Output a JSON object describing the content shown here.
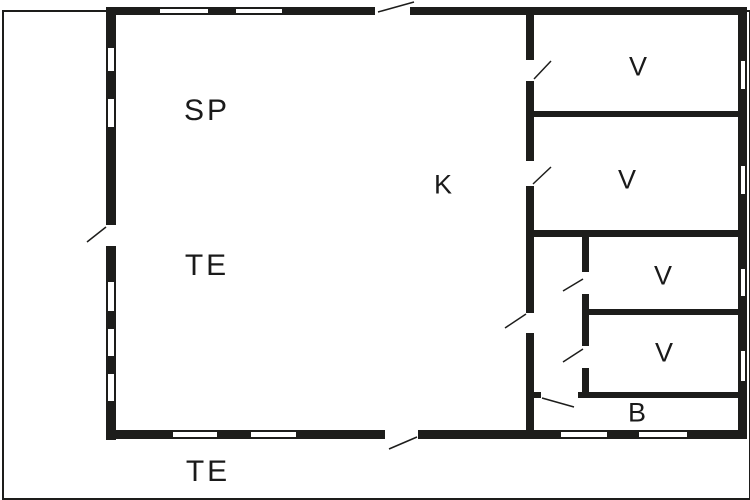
{
  "diagram": {
    "type": "floor-plan",
    "background_color": "#ffffff",
    "wall_color": "#1d1d1b",
    "line_color": "#1d1d1b",
    "rooms": [
      {
        "id": "sp",
        "label": "SP"
      },
      {
        "id": "te-inner",
        "label": "TE"
      },
      {
        "id": "k",
        "label": "K"
      },
      {
        "id": "v1",
        "label": "V"
      },
      {
        "id": "v2",
        "label": "V"
      },
      {
        "id": "v3",
        "label": "V"
      },
      {
        "id": "v4",
        "label": "V"
      },
      {
        "id": "b",
        "label": "B"
      },
      {
        "id": "te-outer",
        "label": "TE"
      }
    ],
    "frame": {
      "name": "plot-boundary",
      "x": 2,
      "y": 10,
      "w": 745,
      "h": 486
    },
    "walls": [
      {
        "name": "wall-exterior-top",
        "x": 106,
        "y": 7,
        "w": 641,
        "h": 8
      },
      {
        "name": "wall-exterior-left",
        "x": 106,
        "y": 7,
        "w": 10,
        "h": 433
      },
      {
        "name": "wall-exterior-bottom",
        "x": 106,
        "y": 430,
        "w": 641,
        "h": 9
      },
      {
        "name": "wall-exterior-right",
        "x": 738,
        "y": 7,
        "w": 9,
        "h": 432
      },
      {
        "name": "wall-interior-main-vertical",
        "x": 526,
        "y": 13,
        "w": 8,
        "h": 419
      },
      {
        "name": "wall-v1-v2",
        "x": 534,
        "y": 111,
        "w": 204,
        "h": 6
      },
      {
        "name": "wall-v2-hall",
        "x": 534,
        "y": 230,
        "w": 204,
        "h": 7
      },
      {
        "name": "wall-v3-v4",
        "x": 588,
        "y": 309,
        "w": 150,
        "h": 6
      },
      {
        "name": "wall-v4-b",
        "x": 534,
        "y": 392,
        "w": 204,
        "h": 6
      },
      {
        "name": "wall-hall-vertical",
        "x": 582,
        "y": 237,
        "w": 7,
        "h": 161
      }
    ],
    "windows": [
      {
        "name": "window-left-1",
        "x": 107,
        "y": 47,
        "w": 8,
        "h": 25
      },
      {
        "name": "window-left-2",
        "x": 107,
        "y": 98,
        "w": 8,
        "h": 30
      },
      {
        "name": "window-left-3",
        "x": 107,
        "y": 281,
        "w": 8,
        "h": 31
      },
      {
        "name": "window-left-4",
        "x": 107,
        "y": 328,
        "w": 8,
        "h": 29
      },
      {
        "name": "window-left-5",
        "x": 107,
        "y": 373,
        "w": 8,
        "h": 29
      },
      {
        "name": "window-top-1",
        "x": 159,
        "y": 8,
        "w": 50,
        "h": 6
      },
      {
        "name": "window-top-2",
        "x": 235,
        "y": 8,
        "w": 48,
        "h": 6
      },
      {
        "name": "window-bottom-1",
        "x": 172,
        "y": 431,
        "w": 46,
        "h": 7
      },
      {
        "name": "window-bottom-2",
        "x": 250,
        "y": 431,
        "w": 47,
        "h": 7
      },
      {
        "name": "window-bottom-3",
        "x": 560,
        "y": 431,
        "w": 48,
        "h": 7
      },
      {
        "name": "window-bottom-4",
        "x": 638,
        "y": 431,
        "w": 50,
        "h": 7
      },
      {
        "name": "window-right-1",
        "x": 740,
        "y": 60,
        "w": 6,
        "h": 30
      },
      {
        "name": "window-right-2",
        "x": 740,
        "y": 165,
        "w": 6,
        "h": 30
      },
      {
        "name": "window-right-3",
        "x": 740,
        "y": 268,
        "w": 6,
        "h": 29
      },
      {
        "name": "window-right-4",
        "x": 740,
        "y": 350,
        "w": 6,
        "h": 32
      }
    ],
    "door_gaps": [
      {
        "name": "door-gap-top-entrance",
        "x": 375,
        "y": 6,
        "w": 35,
        "h": 10
      },
      {
        "name": "door-gap-left-entrance",
        "x": 105,
        "y": 225,
        "w": 12,
        "h": 21
      },
      {
        "name": "door-gap-bottom-entrance",
        "x": 385,
        "y": 429,
        "w": 33,
        "h": 11
      },
      {
        "name": "door-gap-v1",
        "x": 525,
        "y": 60,
        "w": 10,
        "h": 21
      },
      {
        "name": "door-gap-v2",
        "x": 525,
        "y": 161,
        "w": 10,
        "h": 25
      },
      {
        "name": "door-gap-k-hall",
        "x": 525,
        "y": 313,
        "w": 10,
        "h": 20
      },
      {
        "name": "door-gap-v3",
        "x": 581,
        "y": 272,
        "w": 9,
        "h": 22
      },
      {
        "name": "door-gap-v4",
        "x": 581,
        "y": 346,
        "w": 9,
        "h": 22
      },
      {
        "name": "door-gap-b",
        "x": 541,
        "y": 391,
        "w": 37,
        "h": 8
      }
    ],
    "door_swings": [
      {
        "name": "door-swing-top-entrance",
        "x1": 378,
        "y1": 12,
        "x2": 414,
        "y2": 2
      },
      {
        "name": "door-swing-left-entrance",
        "x1": 106,
        "y1": 227,
        "x2": 87,
        "y2": 242
      },
      {
        "name": "door-swing-bottom-entrance",
        "x1": 417,
        "y1": 437,
        "x2": 389,
        "y2": 449
      },
      {
        "name": "door-swing-v1",
        "x1": 534,
        "y1": 79,
        "x2": 551,
        "y2": 61
      },
      {
        "name": "door-swing-v2",
        "x1": 533,
        "y1": 184,
        "x2": 551,
        "y2": 167
      },
      {
        "name": "door-swing-k-hall",
        "x1": 526,
        "y1": 314,
        "x2": 505,
        "y2": 328
      },
      {
        "name": "door-swing-v3",
        "x1": 583,
        "y1": 279,
        "x2": 563,
        "y2": 291
      },
      {
        "name": "door-swing-v4",
        "x1": 583,
        "y1": 349,
        "x2": 563,
        "y2": 362
      },
      {
        "name": "door-swing-b",
        "x1": 542,
        "y1": 398,
        "x2": 574,
        "y2": 407
      }
    ]
  }
}
